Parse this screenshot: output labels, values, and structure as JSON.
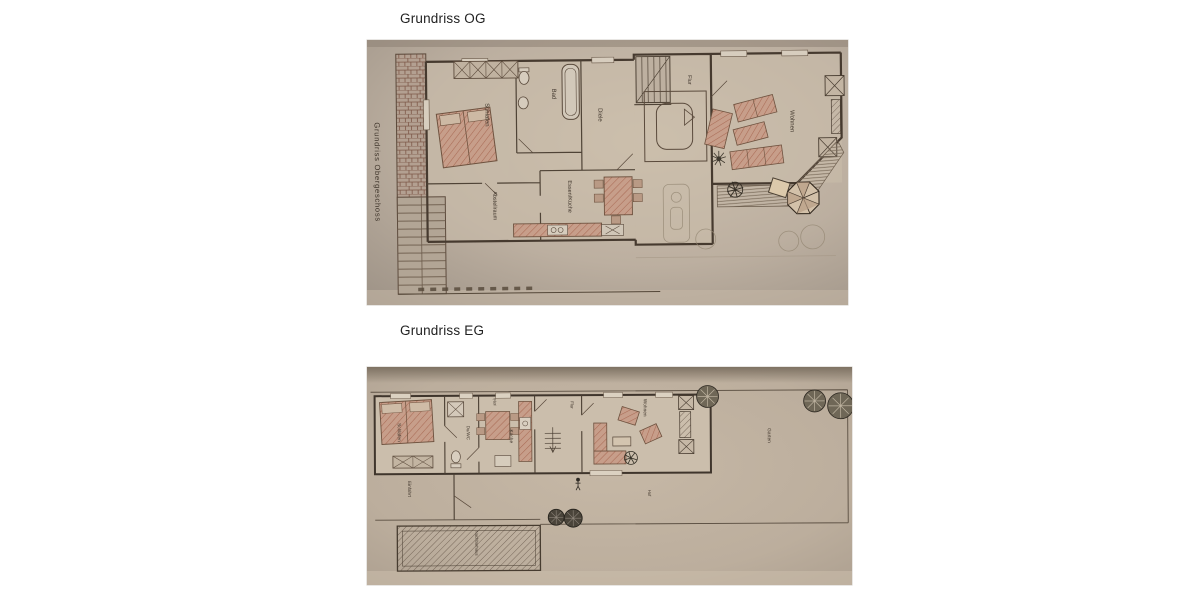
{
  "page": {
    "background": "#ffffff"
  },
  "colors": {
    "page_bg": "#ffffff",
    "photo_paper": "#bfb2a1",
    "ink": "#4a3e32",
    "furniture_pink": "#c79e8a",
    "title_text": "#222222"
  },
  "icons": {
    "tree": "tree-icon",
    "parasol": "parasol-icon",
    "plant": "plant-icon",
    "bed": "bed-icon",
    "bathtub": "bathtub-icon",
    "toilet": "toilet-icon",
    "stairs": "stairs-icon"
  },
  "og": {
    "title": "Grundriss OG",
    "side_label": "Grundriss Obergeschoss",
    "labels": {
      "schlafen": "Schlafen",
      "bad": "Bad",
      "diele": "Diele",
      "flur": "Flur",
      "abstellraum": "Abstellraum",
      "essen_kueche": "Essen/Küche",
      "wohnen": "Wohnen"
    }
  },
  "eg": {
    "title": "Grundriss EG",
    "labels": {
      "schlafen": "Schlafen",
      "du_wc": "Du/WC",
      "kueche": "Küche",
      "flur_front": "Flur",
      "flur_mitte": "Flur",
      "wohnen": "Wohnen",
      "garten": "Garten",
      "einfahrt": "Einfahrt",
      "hof": "Hof",
      "nachbarhaus": "Nachbarhaus"
    }
  }
}
